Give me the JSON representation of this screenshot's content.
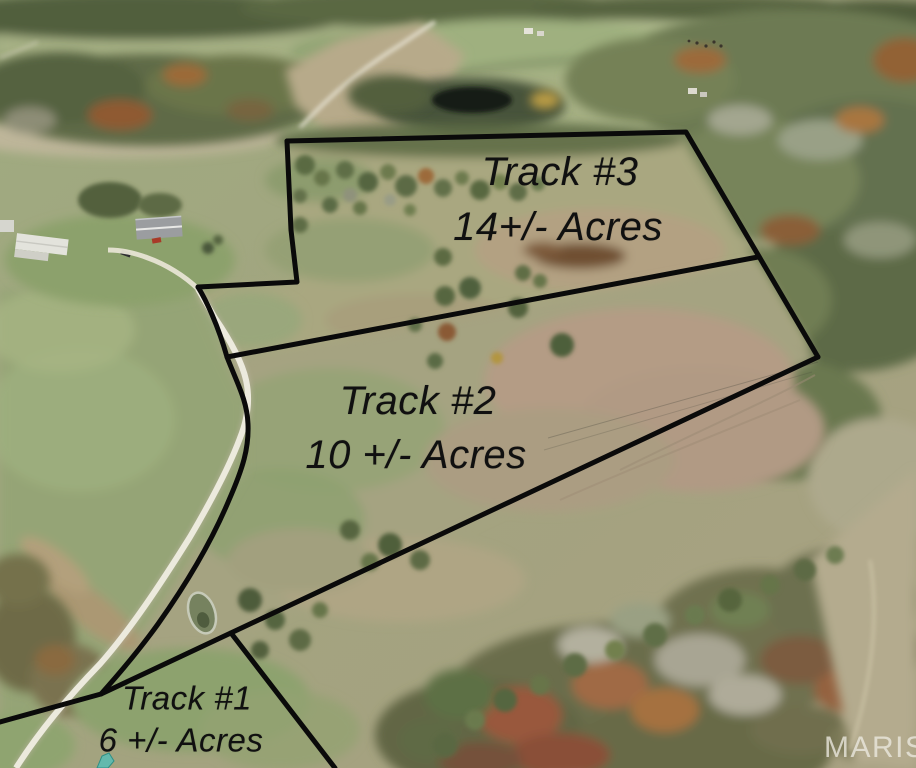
{
  "tracts": [
    {
      "name": "Track #3",
      "acreage": "14+/- Acres"
    },
    {
      "name": "Track #2",
      "acreage": "10 +/- Acres"
    },
    {
      "name": "Track #1",
      "acreage": "6 +/- Acres"
    }
  ],
  "watermark": {
    "text": "MARIS"
  },
  "colors": {
    "boundary_line": "#0a0a0a",
    "label_text": "#101010",
    "watermark_text": "rgba(236,233,224,0.78)",
    "road": "#eceadd",
    "field_green": "#9aa77d",
    "field_tan": "#b6a68c",
    "forest_green": "#66744e",
    "autumn_rust": "#9a5d40",
    "pond_dark": "#1a2115",
    "survey_mark_teal": "#63b9ad"
  }
}
